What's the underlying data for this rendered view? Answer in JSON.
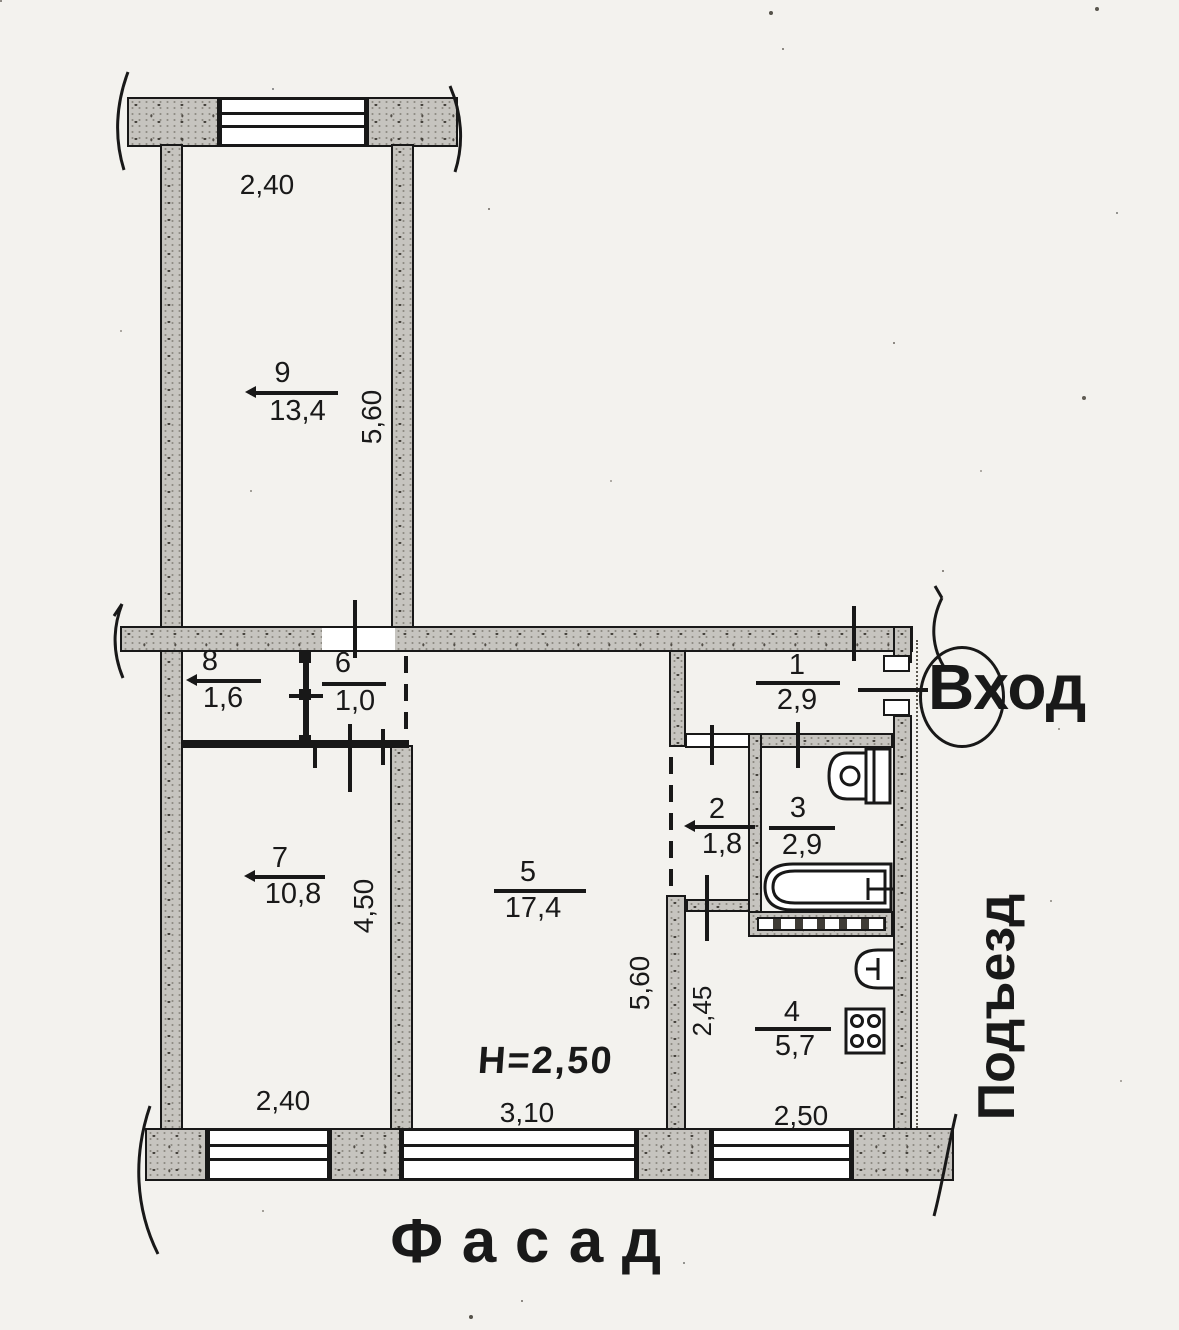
{
  "plan": {
    "rooms": [
      {
        "number": "9",
        "area": "13,4"
      },
      {
        "number": "8",
        "area": "1,6"
      },
      {
        "number": "6",
        "area": "1,0"
      },
      {
        "number": "7",
        "area": "10,8"
      },
      {
        "number": "5",
        "area": "17,4"
      },
      {
        "number": "1",
        "area": "2,9"
      },
      {
        "number": "2",
        "area": "1,8"
      },
      {
        "number": "3",
        "area": "2,9"
      },
      {
        "number": "4",
        "area": "5,7"
      }
    ],
    "dimensions": {
      "top_width": "2,40",
      "room9_depth": "5,60",
      "room7_depth": "4,50",
      "room5_depth": "5,60",
      "hall_depth": "2,45",
      "bottom_left_width": "2,40",
      "bottom_middle_width": "3,10",
      "bottom_right_width": "2,50",
      "ceiling_height": "H=2,50"
    },
    "labels": {
      "entrance": "Вход",
      "stairwell": "Подъезд",
      "facade": "Фасад"
    },
    "fixtures": [
      "toilet-icon",
      "bathtub-icon",
      "sink-icon",
      "stove-icon"
    ],
    "colors": {
      "ink": "#181818",
      "wall_fill": "#c6c4bf",
      "paper": "#f3f2ee"
    }
  }
}
